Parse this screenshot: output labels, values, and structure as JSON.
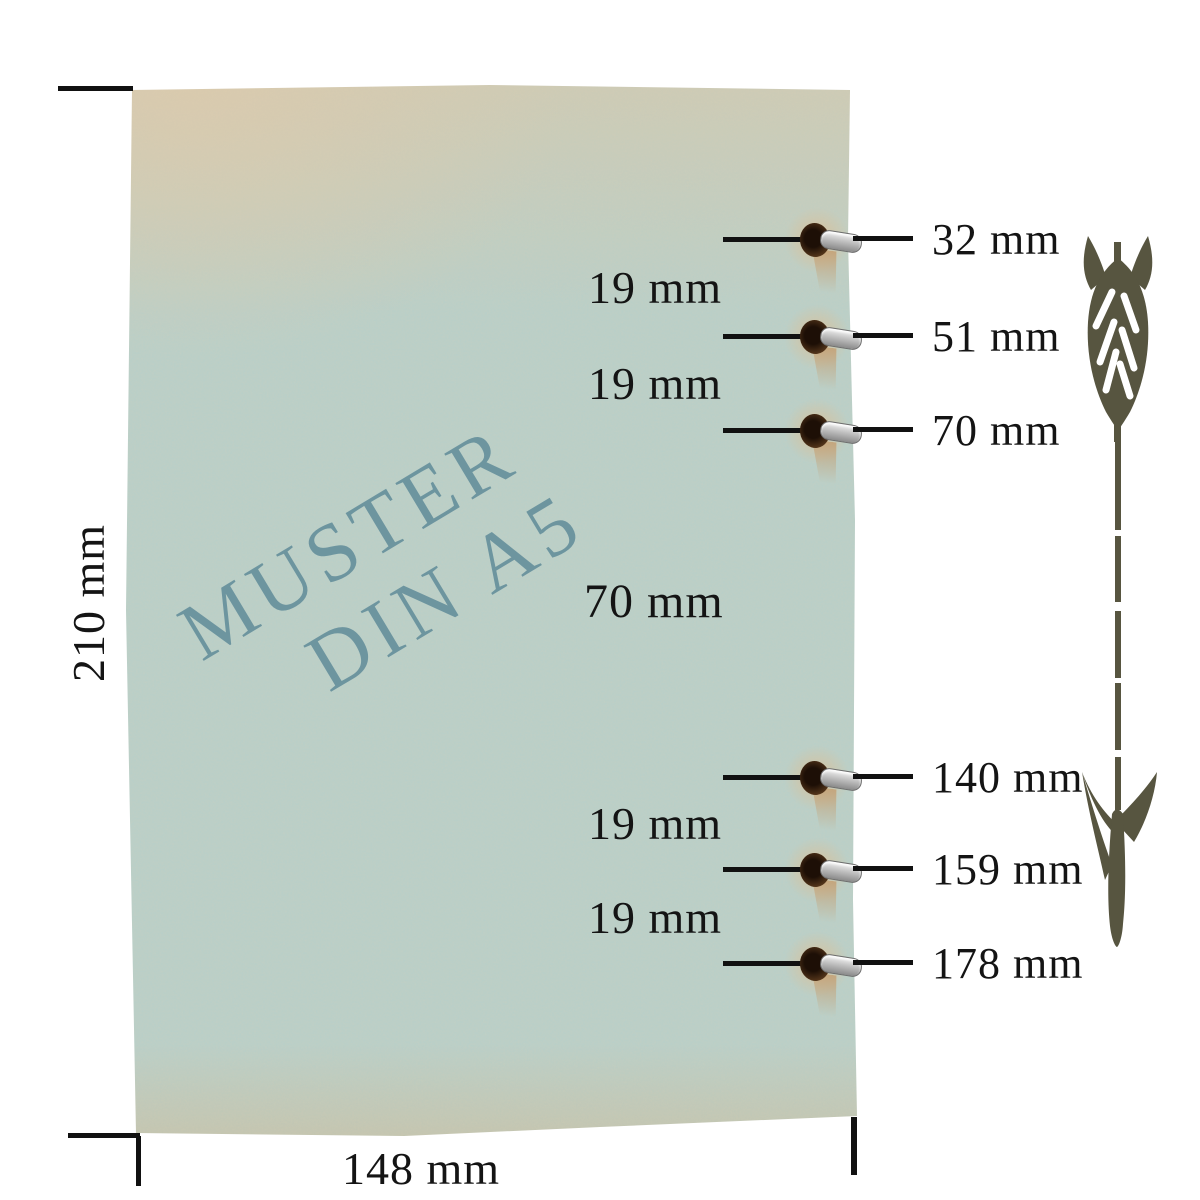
{
  "paper": {
    "watermark": {
      "line1": "MUSTER",
      "line2": "DIN A5"
    },
    "watermark_color": "#68919d",
    "base_color": "#b9cfc8",
    "edge_color": "#d8c8ab",
    "corner_tan_color": "#cbb28a"
  },
  "dimensions": {
    "height_label": "210 mm",
    "width_label": "148 mm"
  },
  "holes": [
    {
      "label": "32 mm"
    },
    {
      "label": "51 mm"
    },
    {
      "label": "70 mm"
    },
    {
      "label": "140 mm"
    },
    {
      "label": "159 mm"
    },
    {
      "label": "178 mm"
    }
  ],
  "gaps": [
    {
      "label": "19 mm"
    },
    {
      "label": "19 mm"
    },
    {
      "label": "70 mm"
    },
    {
      "label": "19 mm"
    },
    {
      "label": "19 mm"
    }
  ],
  "icons": {
    "arrow": "arrow-down-icon",
    "arrow_color": "#575540",
    "hole": "binding-hole",
    "ring": "eyelet-ring"
  },
  "line_color": "#111111"
}
